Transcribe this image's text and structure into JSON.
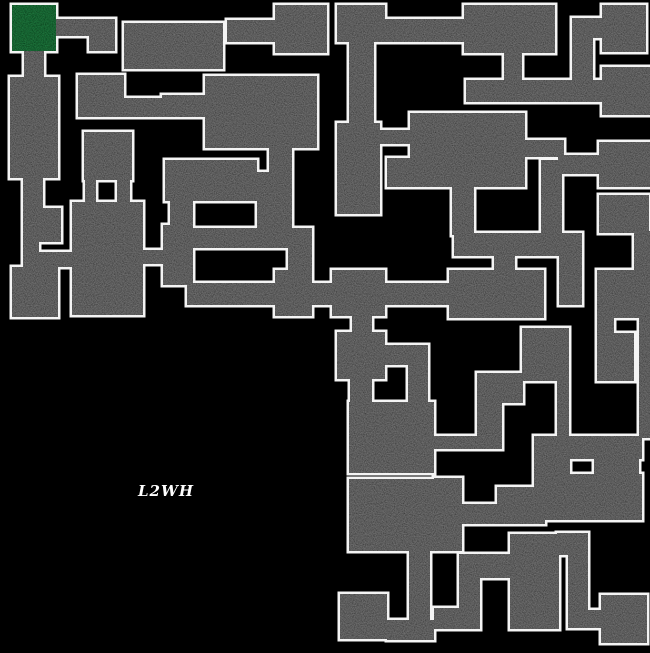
{
  "map": {
    "background_color": "#000000",
    "wall_fill_color": "#757575",
    "border_color": "#f4f4f4",
    "start_room_color": "#237a41",
    "label": {
      "text": "L2WH",
      "x": 138,
      "y": 482,
      "color": "#ffffff"
    },
    "start_room": [
      12,
      5,
      44,
      46
    ],
    "rooms": [
      [
        56,
        19,
        59,
        17
      ],
      [
        89,
        33,
        26,
        18
      ],
      [
        24,
        49,
        20,
        30
      ],
      [
        10,
        77,
        48,
        101
      ],
      [
        23,
        176,
        20,
        34
      ],
      [
        23,
        208,
        38,
        34
      ],
      [
        23,
        240,
        16,
        28
      ],
      [
        12,
        267,
        46,
        50
      ],
      [
        38,
        252,
        38,
        15
      ],
      [
        72,
        202,
        71,
        113
      ],
      [
        85,
        172,
        11,
        32
      ],
      [
        117,
        172,
        13,
        32
      ],
      [
        84,
        132,
        48,
        48
      ],
      [
        78,
        75,
        46,
        42
      ],
      [
        124,
        98,
        40,
        19
      ],
      [
        162,
        95,
        45,
        22
      ],
      [
        143,
        250,
        24,
        14
      ],
      [
        163,
        225,
        30,
        60
      ],
      [
        170,
        201,
        23,
        26
      ],
      [
        165,
        160,
        92,
        41
      ],
      [
        205,
        76,
        112,
        72
      ],
      [
        269,
        148,
        23,
        27
      ],
      [
        250,
        172,
        42,
        22
      ],
      [
        257,
        192,
        35,
        38
      ],
      [
        124,
        23,
        99,
        46
      ],
      [
        227,
        20,
        48,
        22
      ],
      [
        275,
        5,
        52,
        48
      ],
      [
        337,
        5,
        48,
        37
      ],
      [
        349,
        40,
        25,
        86
      ],
      [
        337,
        123,
        43,
        91
      ],
      [
        385,
        19,
        81,
        23
      ],
      [
        464,
        5,
        91,
        48
      ],
      [
        504,
        51,
        18,
        32
      ],
      [
        466,
        80,
        184,
        22
      ],
      [
        572,
        18,
        30,
        20
      ],
      [
        572,
        18,
        21,
        66
      ],
      [
        602,
        5,
        44,
        47
      ],
      [
        602,
        67,
        48,
        48
      ],
      [
        410,
        113,
        115,
        74
      ],
      [
        387,
        158,
        25,
        29
      ],
      [
        380,
        130,
        32,
        14
      ],
      [
        452,
        185,
        22,
        50
      ],
      [
        454,
        233,
        128,
        23
      ],
      [
        559,
        254,
        23,
        51
      ],
      [
        494,
        254,
        21,
        18
      ],
      [
        449,
        270,
        95,
        48
      ],
      [
        187,
        283,
        263,
        22
      ],
      [
        193,
        228,
        119,
        20
      ],
      [
        288,
        246,
        24,
        26
      ],
      [
        275,
        270,
        37,
        46
      ],
      [
        332,
        270,
        53,
        46
      ],
      [
        352,
        314,
        20,
        20
      ],
      [
        337,
        332,
        48,
        47
      ],
      [
        350,
        377,
        22,
        27
      ],
      [
        385,
        345,
        43,
        20
      ],
      [
        408,
        363,
        20,
        42
      ],
      [
        349,
        402,
        85,
        71
      ],
      [
        349,
        479,
        85,
        72
      ],
      [
        599,
        195,
        50,
        38
      ],
      [
        634,
        231,
        16,
        41
      ],
      [
        597,
        270,
        53,
        48
      ],
      [
        597,
        316,
        17,
        19
      ],
      [
        639,
        316,
        11,
        19
      ],
      [
        597,
        333,
        37,
        48
      ],
      [
        639,
        333,
        11,
        105
      ],
      [
        522,
        328,
        47,
        53
      ],
      [
        477,
        373,
        46,
        30
      ],
      [
        477,
        403,
        25,
        46
      ],
      [
        557,
        381,
        12,
        57
      ],
      [
        525,
        140,
        39,
        17
      ],
      [
        558,
        155,
        41,
        19
      ],
      [
        599,
        142,
        51,
        45
      ],
      [
        541,
        160,
        21,
        75
      ],
      [
        434,
        436,
        63,
        13
      ],
      [
        534,
        436,
        108,
        23
      ],
      [
        534,
        459,
        36,
        30
      ],
      [
        594,
        459,
        45,
        16
      ],
      [
        545,
        474,
        97,
        46
      ],
      [
        497,
        487,
        48,
        37
      ],
      [
        462,
        504,
        35,
        20
      ],
      [
        434,
        478,
        28,
        73
      ],
      [
        510,
        534,
        49,
        95
      ],
      [
        459,
        554,
        51,
        24
      ],
      [
        459,
        578,
        21,
        51
      ],
      [
        434,
        608,
        25,
        21
      ],
      [
        387,
        620,
        47,
        20
      ],
      [
        340,
        594,
        47,
        45
      ],
      [
        409,
        551,
        21,
        72
      ],
      [
        557,
        533,
        31,
        22
      ],
      [
        568,
        555,
        20,
        57
      ],
      [
        568,
        610,
        33,
        18
      ],
      [
        601,
        595,
        46,
        48
      ]
    ]
  }
}
